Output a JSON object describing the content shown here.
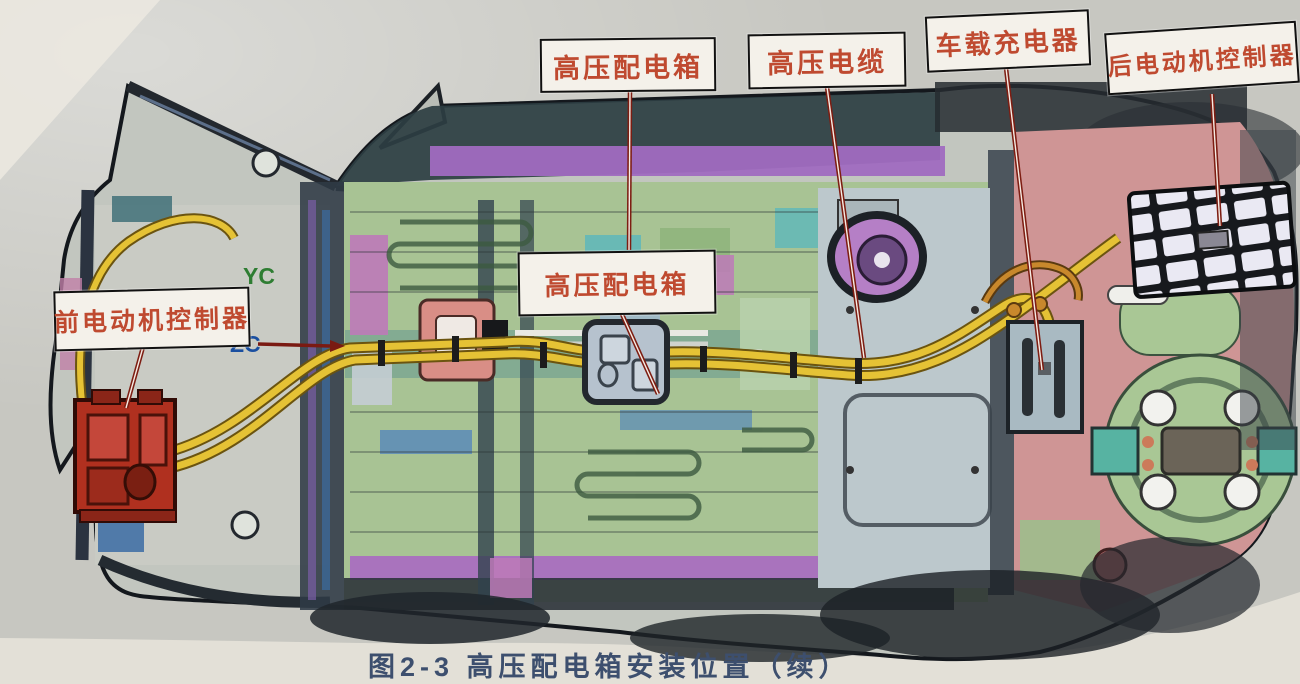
{
  "figure": {
    "caption": "图2-3 高压配电箱安装位置（续）",
    "axis_marker": {
      "y_axis": "YC",
      "z_axis": "ZC"
    }
  },
  "callouts": {
    "hv_distribution_box_top": {
      "label": "高压配电箱"
    },
    "hv_cable": {
      "label": "高压电缆"
    },
    "onboard_charger": {
      "label": "车载充电器"
    },
    "rear_motor_controller": {
      "label": "后电动机控制器"
    },
    "front_motor_controller": {
      "label": "前电动机控制器"
    },
    "hv_distribution_box_mid": {
      "label": "高压配电箱"
    }
  },
  "colors": {
    "callout_text": "#bf4a30",
    "callout_bg": "#f4f1ea",
    "leader_line_red": "#7d1d12",
    "hv_cable_yellow": "#e5c235",
    "front_controller_red": "#b0301f",
    "distribution_box_gray": "#b6c2ce",
    "charger_gray": "#a9bac2",
    "rear_controller_white": "#eae9f3",
    "floor_green": "#a8c394",
    "rear_floor_pink": "#cf9595",
    "cowl_purple": "#a06cc0",
    "photo_background": "#c7c7c1",
    "paper": "#e3e0d7",
    "axis_y_green": "#2e7d32",
    "axis_z_blue": "#1a4fa0",
    "caption_blue": "#3d4f6e"
  }
}
